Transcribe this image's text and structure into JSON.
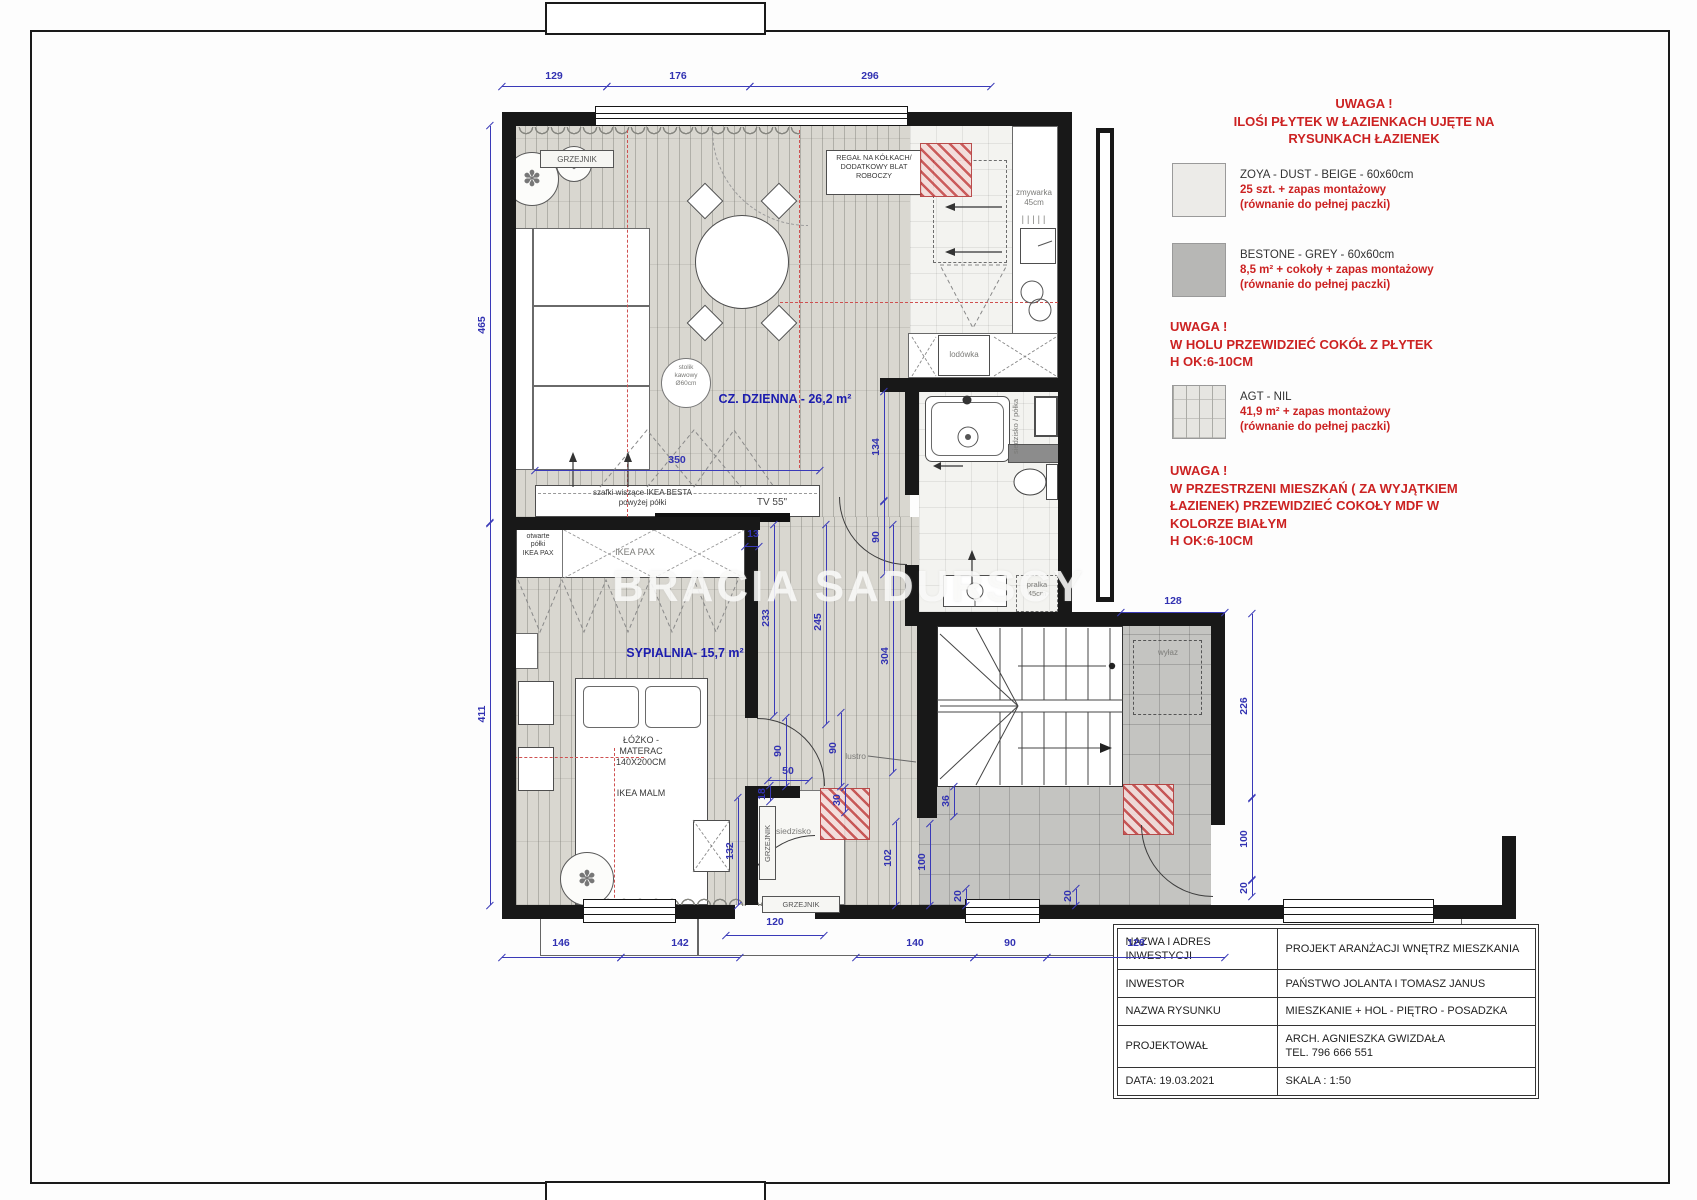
{
  "watermark": "BRACIA SADURSCY",
  "legend": {
    "heading": [
      "UWAGA !",
      "ILOŚI PŁYTEK W ŁAZIENKACH UJĘTE NA",
      "RYSUNKACH ŁAZIENEK"
    ],
    "items": [
      {
        "name": "ZOYA - DUST - BEIGE - 60x60cm",
        "qty": "25 szt. + zapas montażowy",
        "note": "(równanie do pełnej paczki)",
        "swatch_color": "#ecebe8"
      },
      {
        "name": "BESTONE - GREY - 60x60cm",
        "qty": "8,5 m² + cokoły + zapas montażowy",
        "note": "(równanie do pełnej paczki)",
        "swatch_color": "#b7b7b5"
      },
      {
        "name": "AGT - NIL",
        "qty": "41,9 m² + zapas montażowy",
        "note": "(równanie do pełnej paczki)",
        "swatch_color": "plank-pattern"
      }
    ],
    "note_hall": [
      "UWAGA !",
      "W HOLU PRZEWIDZIEĆ COKÓŁ Z PŁYTEK",
      "H OK:6-10CM"
    ],
    "note_mdf": [
      "UWAGA !",
      "W PRZESTRZENI MIESZKAŃ ( ZA WYJĄTKIEM",
      "ŁAZIENEK) PRZEWIDZIEĆ COKOŁY MDF W",
      "KOLORZE BIAŁYM",
      "H OK:6-10CM"
    ]
  },
  "bottom_note": "WSZYSTKIE WYMIARY ZWERYFIKOWAĆ NA MIEJSCU REALIZACJI",
  "titleblock": {
    "rows": [
      {
        "label": [
          "NAZWA I ADRES",
          "INWESTYCJI"
        ],
        "value": [
          "PROJEKT ARANŻACJI WNĘTRZ MIESZKANIA"
        ]
      },
      {
        "label": [
          "INWESTOR"
        ],
        "value": [
          "PAŃSTWO JOLANTA I TOMASZ JANUS"
        ]
      },
      {
        "label": [
          "NAZWA RYSUNKU"
        ],
        "value": [
          "MIESZKANIE + HOL - PIĘTRO - POSADZKA"
        ]
      },
      {
        "label": [
          "PROJEKTOWAŁ"
        ],
        "value": [
          "ARCH. AGNIESZKA GWIZDAŁA",
          "TEL. 796 666 551"
        ]
      },
      {
        "label": [
          "DATA: 19.03.2021"
        ],
        "value": [
          "SKALA : 1:50"
        ]
      }
    ]
  },
  "plan": {
    "rooms": {
      "living": "CZ. DZIENNA - 26,2 m²",
      "bedroom": "SYPIALNIA- 15,7 m²",
      "hall": "HOL- 8,5 m²"
    },
    "labels": {
      "grzejnik_top": "GRZEJNIK",
      "grzejnik_vert": "GRZEJNIK",
      "grzejnik_bottom": "GRZEJNIK",
      "regal": [
        "REGAŁ NA KÓŁKACH/",
        "DODATKOWY BLAT",
        "ROBOCZY"
      ],
      "zmywarka": [
        "zmywarka",
        "45cm"
      ],
      "lodowka": "lodówka",
      "stolik": [
        "stolik",
        "kawowy",
        "Ø60cm"
      ],
      "besta": [
        "szafki wiszące IKEA BESTA",
        "powyżej półki"
      ],
      "tv": "TV 55\"",
      "otwarte": [
        "otwarte",
        "półki",
        "IKEA PAX"
      ],
      "ikea_pax": "IKEA PAX",
      "lozko": [
        "ŁÓŻKO -",
        "MATERAC",
        "140X200CM"
      ],
      "ikea_malm": "IKEA MALM",
      "siedzisko_polka": [
        "siedzisko",
        "/ półka"
      ],
      "pralka": [
        "pralka",
        "45cm"
      ],
      "lustro": "lustro",
      "wylaz": "wyłaz",
      "siedzisko": "siedzisko"
    },
    "dims": [
      {
        "t": "129",
        "x": 554,
        "y": 76,
        "r": 0
      },
      {
        "t": "176",
        "x": 678,
        "y": 76,
        "r": 0
      },
      {
        "t": "296",
        "x": 870,
        "y": 76,
        "r": 0
      },
      {
        "t": "465",
        "x": 482,
        "y": 325,
        "r": 1
      },
      {
        "t": "411",
        "x": 482,
        "y": 714,
        "r": 1
      },
      {
        "t": "350",
        "x": 677,
        "y": 460,
        "r": 0
      },
      {
        "t": "13",
        "x": 753,
        "y": 534,
        "r": 0
      },
      {
        "t": "233",
        "x": 766,
        "y": 618,
        "r": 1
      },
      {
        "t": "245",
        "x": 818,
        "y": 622,
        "r": 1
      },
      {
        "t": "304",
        "x": 885,
        "y": 656,
        "r": 1
      },
      {
        "t": "134",
        "x": 876,
        "y": 447,
        "r": 1
      },
      {
        "t": "90",
        "x": 876,
        "y": 537,
        "r": 1
      },
      {
        "t": "90",
        "x": 778,
        "y": 751,
        "r": 1
      },
      {
        "t": "90",
        "x": 833,
        "y": 748,
        "r": 1
      },
      {
        "t": "50",
        "x": 788,
        "y": 771,
        "r": 0
      },
      {
        "t": "18",
        "x": 762,
        "y": 794,
        "r": 1
      },
      {
        "t": "30",
        "x": 837,
        "y": 800,
        "r": 1
      },
      {
        "t": "132",
        "x": 730,
        "y": 851,
        "r": 1
      },
      {
        "t": "102",
        "x": 888,
        "y": 858,
        "r": 1
      },
      {
        "t": "100",
        "x": 922,
        "y": 862,
        "r": 1
      },
      {
        "t": "36",
        "x": 946,
        "y": 801,
        "r": 1
      },
      {
        "t": "20",
        "x": 958,
        "y": 896,
        "r": 1
      },
      {
        "t": "20",
        "x": 1068,
        "y": 896,
        "r": 1
      },
      {
        "t": "128",
        "x": 1173,
        "y": 601,
        "r": 0
      },
      {
        "t": "226",
        "x": 1244,
        "y": 706,
        "r": 1
      },
      {
        "t": "100",
        "x": 1244,
        "y": 839,
        "r": 1
      },
      {
        "t": "20",
        "x": 1244,
        "y": 888,
        "r": 1
      },
      {
        "t": "120",
        "x": 775,
        "y": 922,
        "r": 0
      },
      {
        "t": "146",
        "x": 561,
        "y": 943,
        "r": 0
      },
      {
        "t": "142",
        "x": 680,
        "y": 943,
        "r": 0
      },
      {
        "t": "140",
        "x": 915,
        "y": 943,
        "r": 0
      },
      {
        "t": "90",
        "x": 1010,
        "y": 943,
        "r": 0
      },
      {
        "t": "128",
        "x": 1136,
        "y": 943,
        "r": 0
      }
    ]
  }
}
